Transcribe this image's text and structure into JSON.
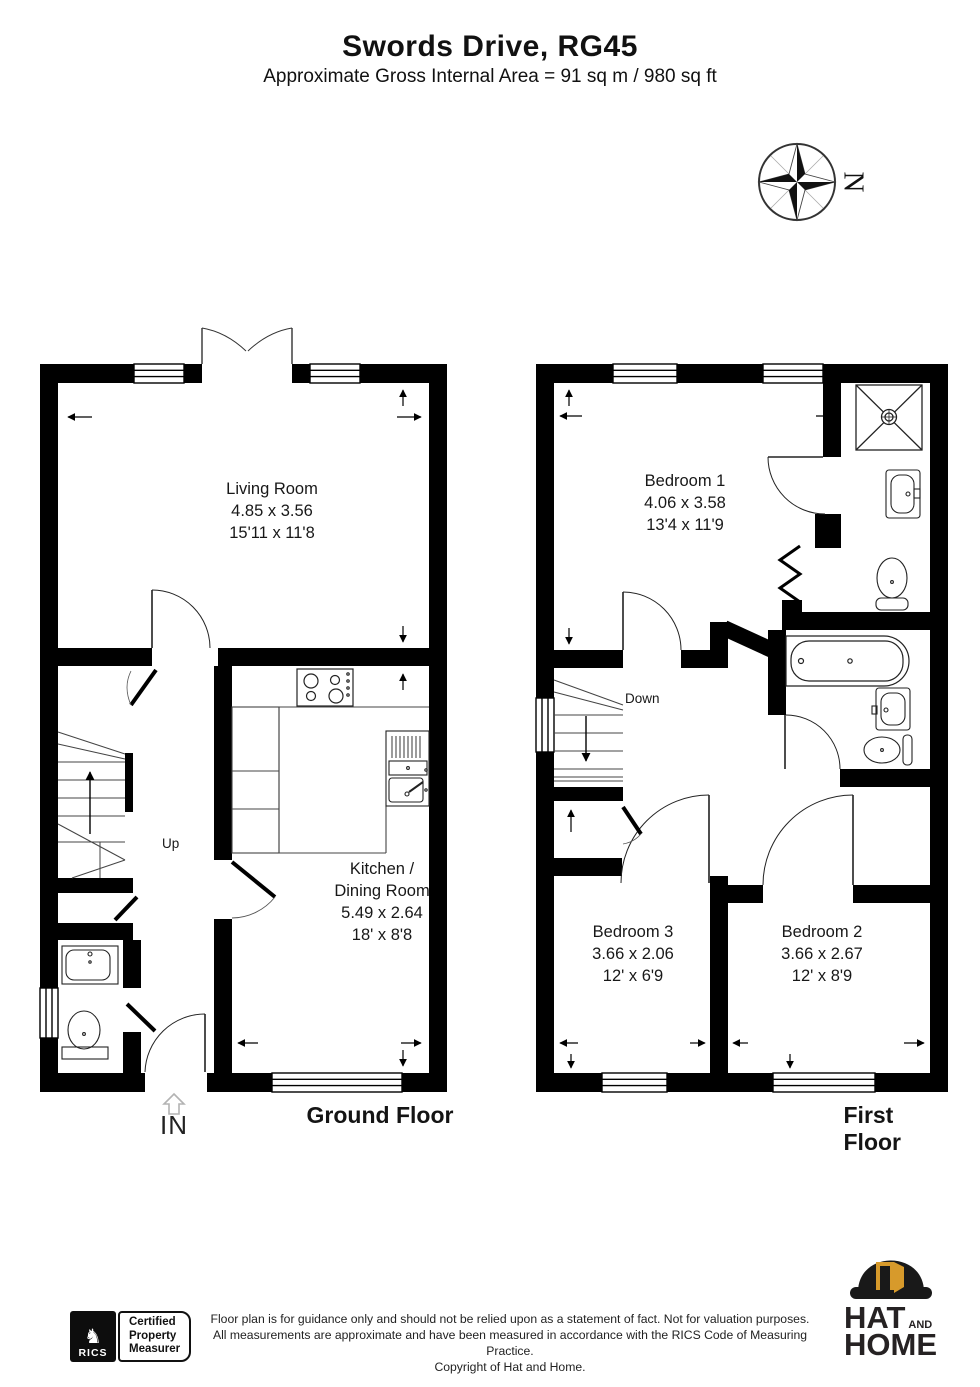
{
  "header": {
    "title": "Swords Drive, RG45",
    "subtitle": "Approximate Gross Internal Area = 91 sq m / 980 sq ft"
  },
  "compass": {
    "north_label": "N"
  },
  "ground_floor": {
    "title": "Ground Floor",
    "entrance_label": "IN",
    "stairs_label": "Up",
    "living_room": {
      "lines": [
        "Living Room",
        "4.85 x 3.56",
        "15'11 x 11'8"
      ]
    },
    "kitchen": {
      "lines": [
        "Kitchen /",
        "Dining Room",
        "5.49 x 2.64",
        "18' x 8'8"
      ]
    }
  },
  "first_floor": {
    "title": "First Floor",
    "stairs_label": "Down",
    "bedroom1": {
      "lines": [
        "Bedroom 1",
        "4.06 x 3.58",
        "13'4 x 11'9"
      ]
    },
    "bedroom2": {
      "lines": [
        "Bedroom 2",
        "3.66 x 2.67",
        "12' x 8'9"
      ]
    },
    "bedroom3": {
      "lines": [
        "Bedroom 3",
        "3.66 x 2.06",
        "12' x 6'9"
      ]
    }
  },
  "footer": {
    "rics_label": "RICS",
    "certification_lines": [
      "Certified",
      "Property",
      "Measurer"
    ],
    "disclaimer_lines": [
      "Floor plan is for guidance only and should not be relied upon as a statement of fact. Not for valuation purposes.",
      "All measurements are approximate and have been measured in accordance with the RICS Code of Measuring Practice.",
      "Copyright of Hat and Home."
    ],
    "brand": {
      "word1": "HAT",
      "word_and": "AND",
      "word2": "HOME"
    }
  },
  "colors": {
    "wall": "#000000",
    "door_gold": "#D79A2B",
    "arrow_gray": "#b3b3b3"
  }
}
